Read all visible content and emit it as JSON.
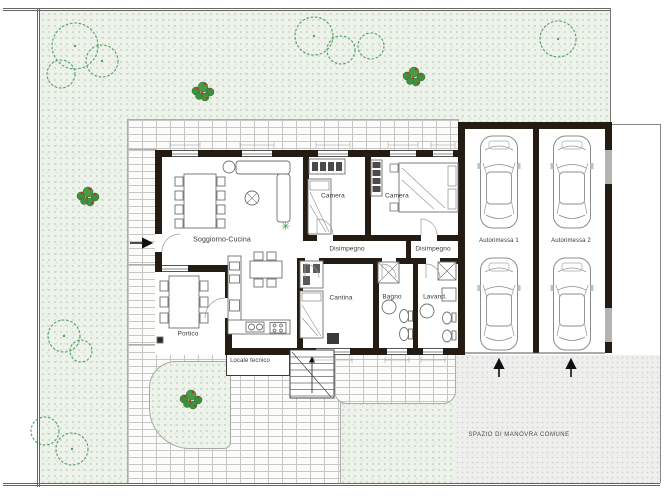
{
  "drawing": {
    "kind": "residential ground floor plan with garden, double garage and common maneuvering area"
  },
  "labels": {
    "soggiorno": "Soggiorno-Cucina",
    "camera_1": "Camera",
    "camera_2": "Camera",
    "disimpegno_1": "Disimpegno",
    "disimpegno_2": "Disimpegno",
    "cantina": "Cantina",
    "bagno": "Bagno",
    "lavanderia": "Lavand.",
    "locale_tecnico": "Locale tecnico",
    "portico": "Portico",
    "autorimessa_1": "Autorimessa 1",
    "autorimessa_2": "Autorimessa 2",
    "spazio_manovra": "SPAZIO DI MANOVRA COMUNE"
  },
  "colors": {
    "wall": "#241c12",
    "grass": "#edf2ea",
    "paving_joint": "#c7c7c5",
    "driveway": "#efefee",
    "tree_outline": "#55a068",
    "bush_green": "#3f8f3c",
    "flower_red": "#c62f2f",
    "plant_star": "#2f9e44",
    "furniture_line": "#707070"
  }
}
